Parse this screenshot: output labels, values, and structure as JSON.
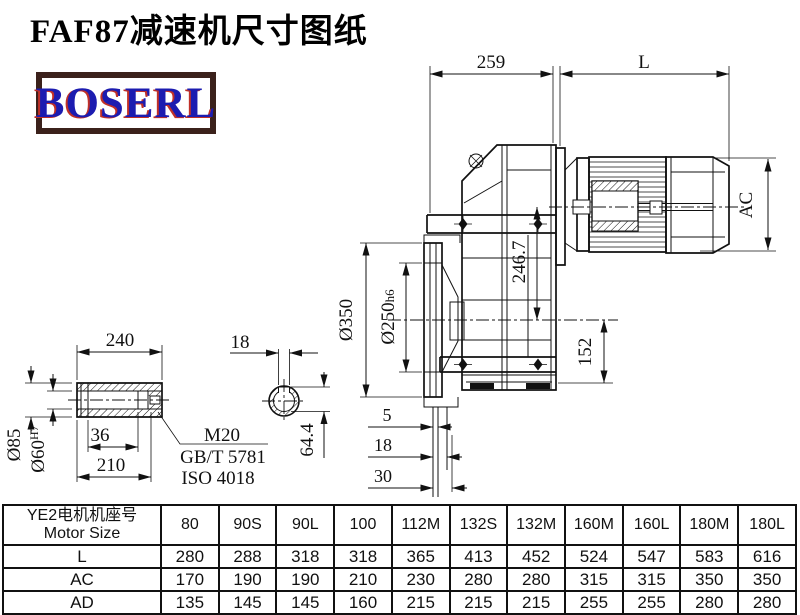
{
  "title": "FAF87减速机尺寸图纸",
  "logo_text": "BOSERL",
  "colors": {
    "drawing_line": "#111111",
    "logo_text_color": "#1c1cb0",
    "logo_shadow": "#c03028",
    "logo_border": "#3b211b"
  },
  "main_view": {
    "dim_top_gear": "259",
    "dim_top_motor": "L",
    "dim_motor_diameter": "AC",
    "dim_axis_offset": "246.7",
    "dim_axis_to_bottom": "152",
    "dim_flange_od": "Ø350",
    "dim_spigot": "Ø250",
    "dim_spigot_tol": "h6",
    "dim_face_5": "5",
    "dim_face_18": "18",
    "dim_face_30": "30"
  },
  "shaft_view": {
    "dim_length": "240",
    "dim_od": "Ø85",
    "dim_bore": "Ø60",
    "dim_bore_tol": "H7",
    "dim_36": "36",
    "dim_210": "210",
    "thread": "M20",
    "standard_gb": "GB/T 5781",
    "standard_iso": "ISO 4018",
    "dim_keyway_width": "18",
    "dim_keyway_height": "64.4"
  },
  "table": {
    "header_cn": "YE2电机机座号",
    "header_en": "Motor Size",
    "columns": [
      "80",
      "90S",
      "90L",
      "100",
      "112M",
      "132S",
      "132M",
      "160M",
      "160L",
      "180M",
      "180L"
    ],
    "rows": [
      {
        "label": "L",
        "values": [
          "280",
          "288",
          "318",
          "318",
          "365",
          "413",
          "452",
          "524",
          "547",
          "583",
          "616"
        ]
      },
      {
        "label": "AC",
        "values": [
          "170",
          "190",
          "190",
          "210",
          "230",
          "280",
          "280",
          "315",
          "315",
          "350",
          "350"
        ]
      },
      {
        "label": "AD",
        "values": [
          "135",
          "145",
          "145",
          "160",
          "215",
          "215",
          "215",
          "255",
          "255",
          "280",
          "280"
        ]
      }
    ]
  }
}
